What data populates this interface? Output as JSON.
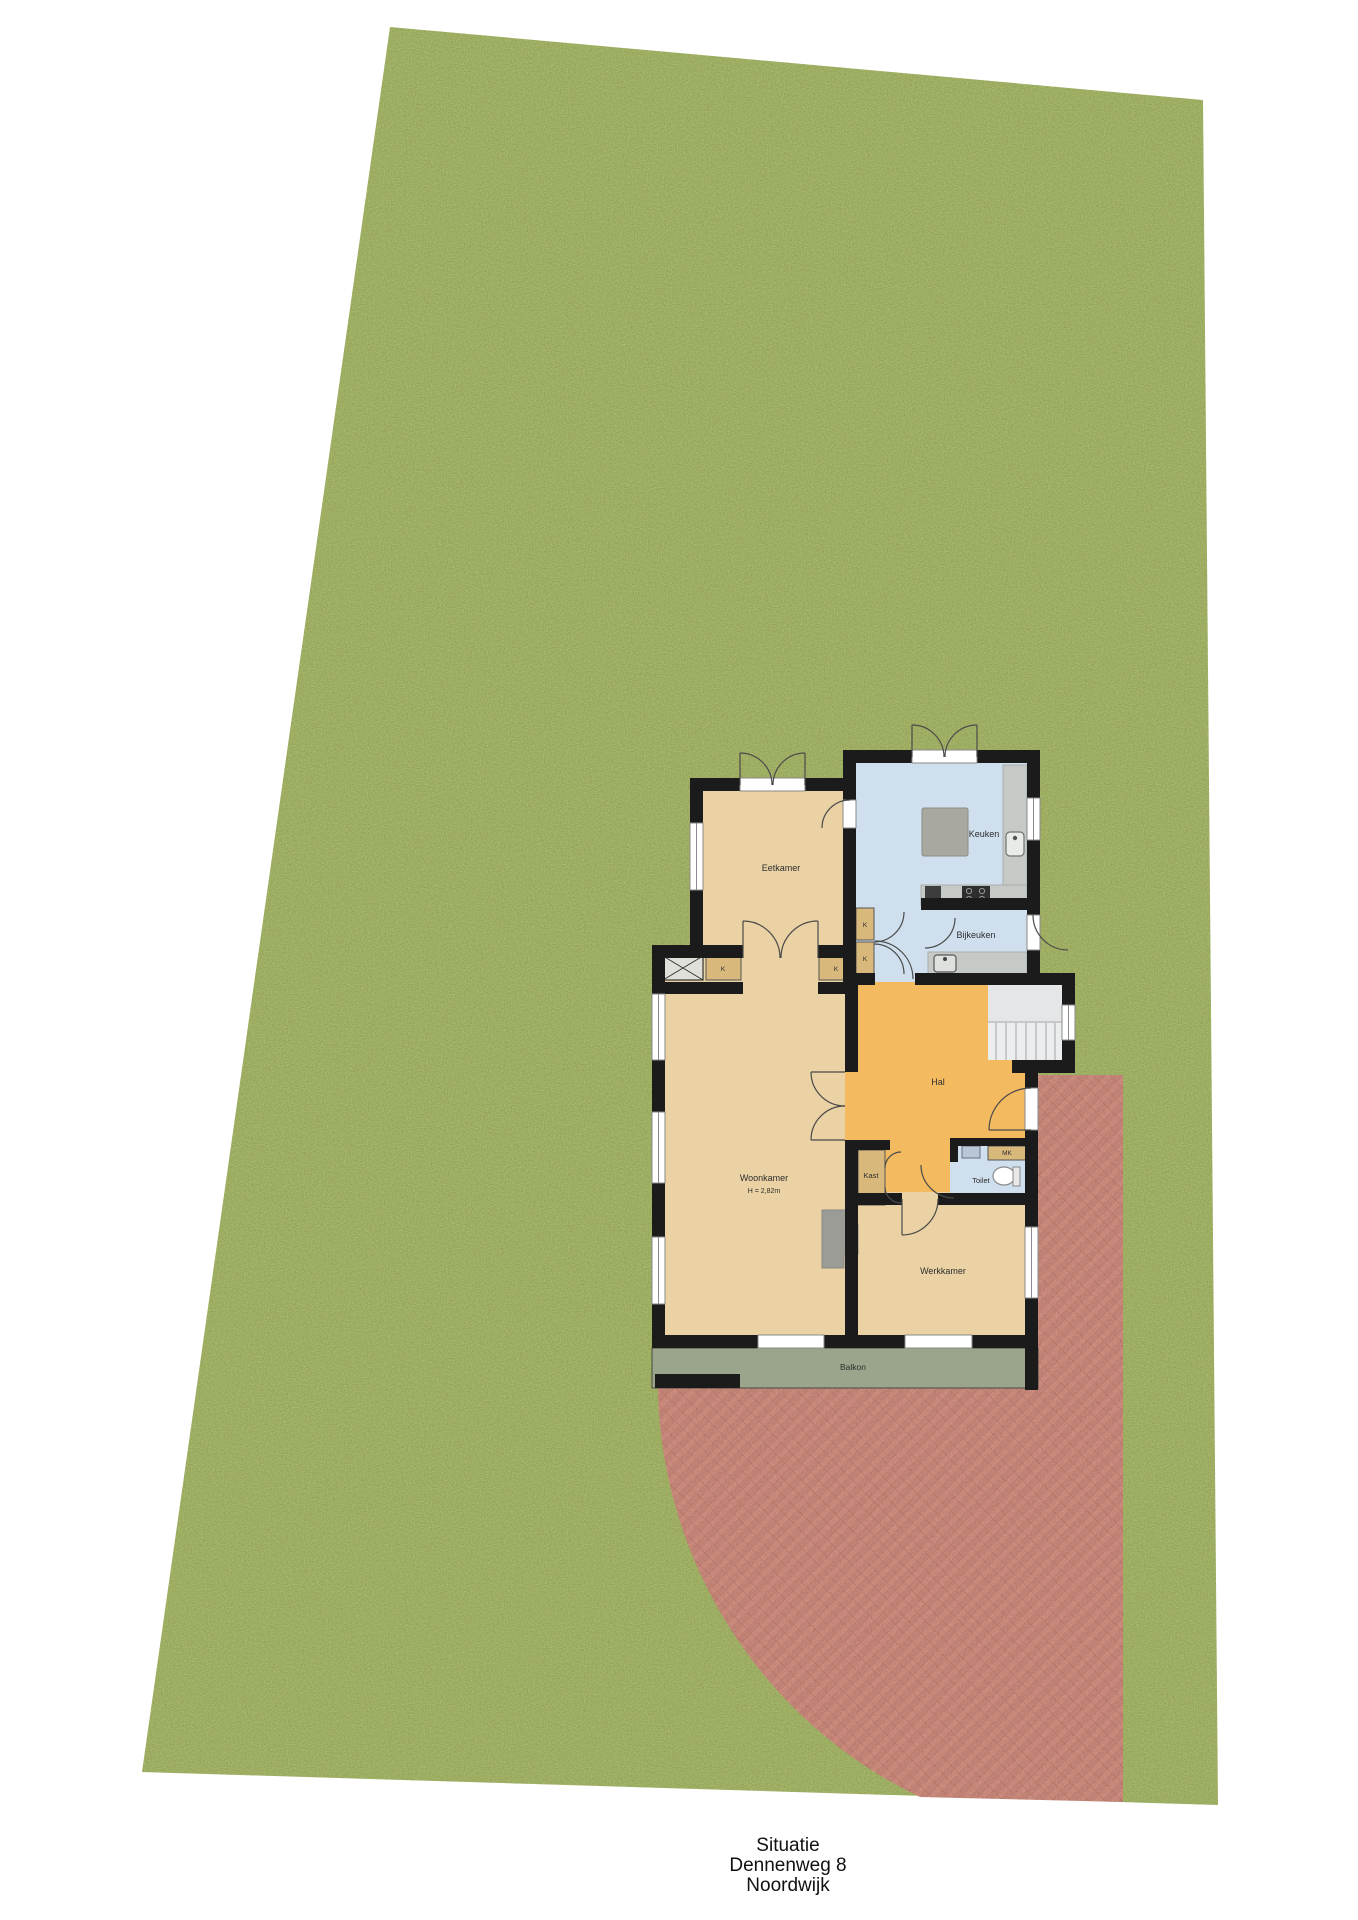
{
  "document": {
    "plan_type": "Situatie",
    "address": "Dennenweg 8",
    "city": "Noordwijk"
  },
  "rooms": {
    "eetkamer": "Eetkamer",
    "keuken": "Keuken",
    "bijkeuken": "Bijkeuken",
    "hal": "Hal",
    "woonkamer": "Woonkamer",
    "woonkamer_ceiling_height": "H = 2,82m",
    "werkkamer": "Werkkamer",
    "balkon": "Balkon",
    "kast": "Kast",
    "toilet": "Toilet",
    "meterkast": "MK",
    "closet_abbrev": "K"
  },
  "colors": {
    "grass": "#7c8d45",
    "terrace_base": "#b4695e",
    "terrace_stripe": "#a55b50",
    "terrace_line": "#96493f",
    "room_tan": "#ead2a4",
    "room_orange": "#f4ba60",
    "room_blue": "#cfdfee",
    "closet_tan": "#d9b87c",
    "wall": "#1b1b1b",
    "balkon_floor": "#9ba58b",
    "counter_gray": "#c6cac6",
    "stairs_gray": "#ecedee"
  }
}
